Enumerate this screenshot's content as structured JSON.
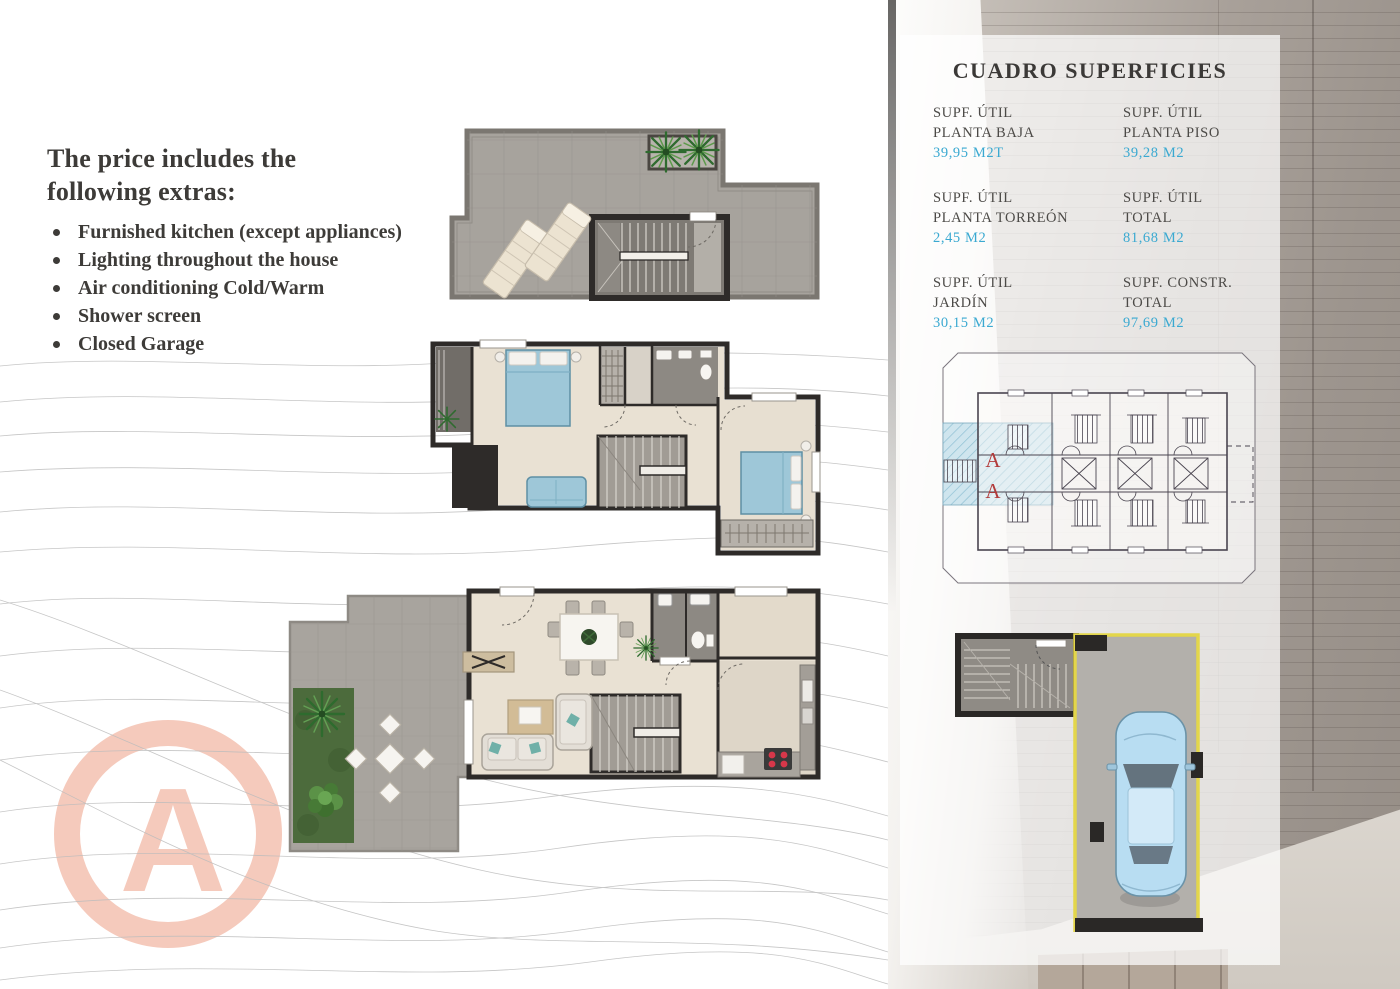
{
  "page": {
    "watermark_letter": "A"
  },
  "extras": {
    "heading_line1": "The price includes the",
    "heading_line2": "following extras:",
    "items": [
      "Furnished kitchen (except appliances)",
      "Lighting throughout the house",
      "Air conditioning Cold/Warm",
      "Shower screen",
      "Closed Garage"
    ]
  },
  "surfaces": {
    "title": "CUADRO SUPERFICIES",
    "entries": [
      {
        "line1": "SUPF. ÚTIL",
        "line2": "PLANTA BAJA",
        "value": "39,95 M2T"
      },
      {
        "line1": "SUPF. ÚTIL",
        "line2": "PLANTA PISO",
        "value": "39,28 M2"
      },
      {
        "line1": "SUPF. ÚTIL",
        "line2": "PLANTA TORREÓN",
        "value": "2,45 M2"
      },
      {
        "line1": "SUPF. ÚTIL",
        "line2": "TOTAL",
        "value": "81,68 M2"
      },
      {
        "line1": "SUPF. ÚTIL",
        "line2": "JARDÍN",
        "value": "30,15 M2"
      },
      {
        "line1": "SUPF. CONSTR.",
        "line2": "TOTAL",
        "value": "97,69 M2"
      }
    ],
    "value_color": "#3aa9d1"
  },
  "site_plan": {
    "unit_label_1": "A",
    "unit_label_2": "A",
    "highlight_color": "#cfe5ee",
    "label_color": "#b23b3b"
  },
  "colors": {
    "accent_cyan": "#3aa9d1",
    "watermark_pink": "#f5cabc",
    "garage_boundary_yellow": "#e3d64b",
    "text_dark": "#3d3b38"
  }
}
